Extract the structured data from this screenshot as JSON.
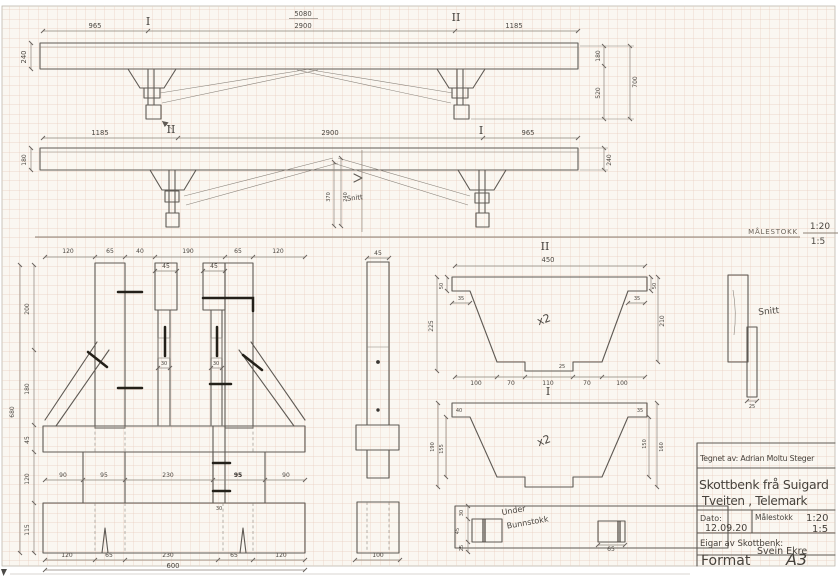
{
  "sheet": {
    "scale_note_label": "MÅLESTOKK",
    "scale_note_v1": "1:20",
    "scale_note_v2": "1:5"
  },
  "title_block": {
    "drawn_by": "Tegnet av: Adrian Moltu Steger",
    "title_line1": "Skottbenk frå Suigard",
    "title_line2": "Tveiten , Telemark",
    "date_label": "Dato:",
    "date_value": "12.09.20",
    "scale_label": "Målestokk",
    "scale_v1": "1:20",
    "scale_v2": "1:5",
    "owner_label": "Eigar av Skottbenk:",
    "owner_value": "Svein Ekre",
    "format_label": "Format",
    "format_value": "A3"
  },
  "sections": {
    "v1_left": "I",
    "v1_right": "II",
    "v2_left": "II",
    "v2_right": "I",
    "trap_top": "II",
    "trap_bottom": "I"
  },
  "labels": {
    "snitt_mid": "Snitt",
    "snitt_right": "Snitt",
    "under_line1": "Under",
    "under_line2": "Bunnstokk",
    "x2_top": "x2",
    "x2_bottom": "x2"
  },
  "dims": {
    "v1": {
      "left": "965",
      "span_top": "5080",
      "span_bottom": "2900",
      "right": "1185",
      "beam_height": "240",
      "r_180": "180",
      "r_520": "520",
      "r_700": "700"
    },
    "v2": {
      "left": "1185",
      "mid": "2900",
      "right": "965",
      "beam_height_left": "180",
      "beam_height_right": "240",
      "peak_a": "370",
      "peak_b": "240"
    },
    "front": {
      "t_1": "120",
      "t_2": "65",
      "t_3": "40",
      "t_4": "190",
      "t_5": "65",
      "t_6": "120",
      "post_a": "45",
      "post_b": "45",
      "tenon_a": "30",
      "tenon_b": "30",
      "strip": "30",
      "m_1": "90",
      "m_2": "95",
      "m_3": "230",
      "m_4": "95",
      "m_5": "90",
      "b_1": "120",
      "b_2": "65",
      "b_3": "230",
      "b_4": "65",
      "b_5": "120",
      "total": "600",
      "h_total": "680",
      "h_1": "200",
      "h_2": "180",
      "h_3": "45",
      "h_4": "120",
      "h_5": "115"
    },
    "side": {
      "width": "45",
      "foot": "100"
    },
    "trap_top": {
      "width": "450",
      "corner_l": "50",
      "corner_r": "50",
      "shoulder_l": "35",
      "shoulder_r": "35",
      "h_left": "225",
      "h_right": "210",
      "b_1": "100",
      "b_2": "70",
      "b_3": "110",
      "b_4": "70",
      "b_5": "100",
      "tab": "25"
    },
    "trap_bot": {
      "h_outer_l": "190",
      "h_inner_l": "155",
      "h_inner_r": "150",
      "h_outer_r": "160",
      "corner_l": "40",
      "corner_r": "35"
    },
    "section_piece": {
      "width": "25"
    },
    "plank": {
      "d_30": "30",
      "d_45": "45",
      "d_25": "25",
      "d_65": "65"
    }
  }
}
